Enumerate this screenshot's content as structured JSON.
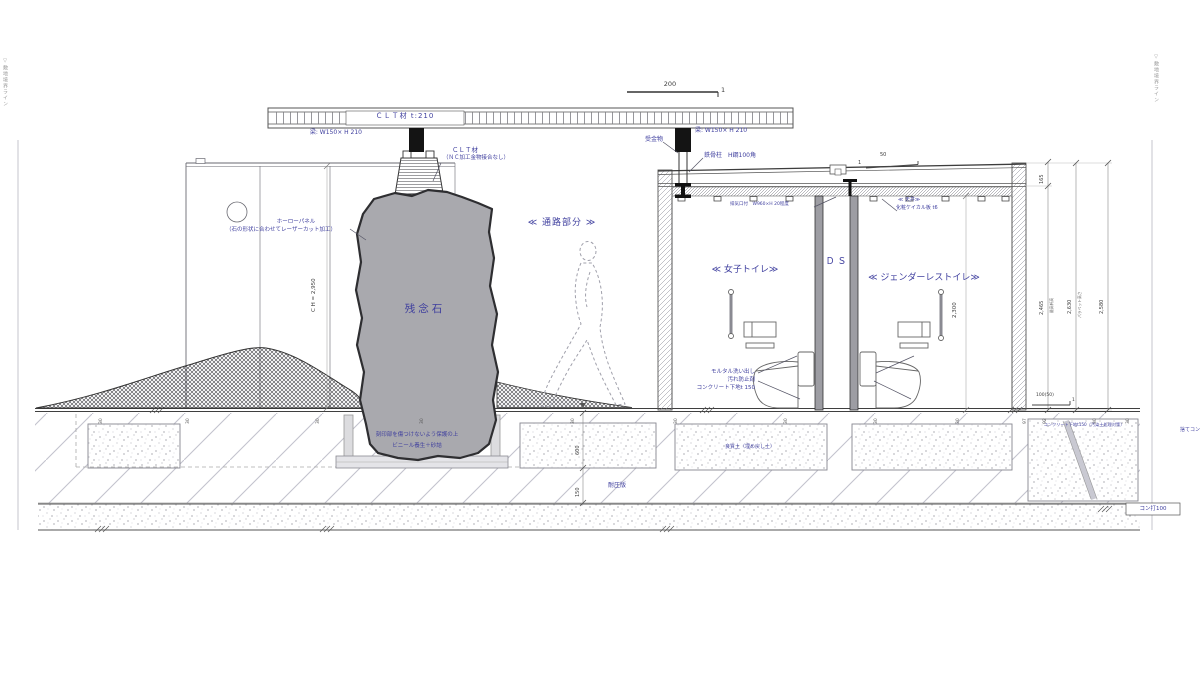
{
  "boundary": {
    "left": "▽敷地境界ライン",
    "right": "▽敷地境界ライン"
  },
  "scale": {
    "top_run": "200",
    "top_rise": "1"
  },
  "canopy": {
    "slab_label": "ＣＬＴ材 t:210",
    "beam_left": "梁: W150× H 210",
    "beam_right": "梁: W150× H 210",
    "hanger": "受金物",
    "column": "鉄骨柱　H鋼100角",
    "clt_note1": "ＣＬＴ材",
    "clt_note2": "（ＮＣ加工金物接合なし）"
  },
  "panel": {
    "note1": "ホーローパネル",
    "note2": "（石の形状に合わせてレーザーカット加工）",
    "ceiling_height": "C H = 2,950"
  },
  "stone": {
    "name": "残念石",
    "note1": "刻印部を傷つけないよう保護の上",
    "note2": "ビニール養生＋砂詰"
  },
  "passage": {
    "label": "≪ 通路部分 ≫"
  },
  "rooms": {
    "left": "≪ 女子トイレ≫",
    "ds": "Ｄ Ｓ",
    "right": "≪ ジェンダーレストイレ≫"
  },
  "roof": {
    "louver": "排気口付　W960×H 20程度",
    "slope_run": "50",
    "slope_rise": "1",
    "ceiling1": "≪ 天井≫",
    "ceiling2": "化粧ケイカル板 t6"
  },
  "floor": {
    "note1": "モルタル洗い出し",
    "note2": "汚れ防止剤",
    "note3": "コンクリート下地t 150"
  },
  "dims": {
    "room_height": "2,300",
    "right1": "165",
    "right2": "2,465",
    "right2_label": "最高軒高",
    "right3": "2,630",
    "right3_label": "パラペット高さ",
    "right4": "2,580",
    "under1": "600",
    "under2": "150",
    "floor_slope_run": "100(50)",
    "floor_slope_rise": "1"
  },
  "underground": {
    "slab": "耐圧版",
    "backfill": "良質土（埋め戻し土）",
    "subbase": "コンクリート下地t150（汚染土処理対策）",
    "lean": "捨てコン",
    "conc100": "コン打100"
  },
  "ground": {
    "ticks": [
      "30",
      "30",
      "30",
      "30",
      "30",
      "30",
      "30",
      "30",
      "30",
      "97",
      "92",
      "30",
      "30"
    ]
  }
}
